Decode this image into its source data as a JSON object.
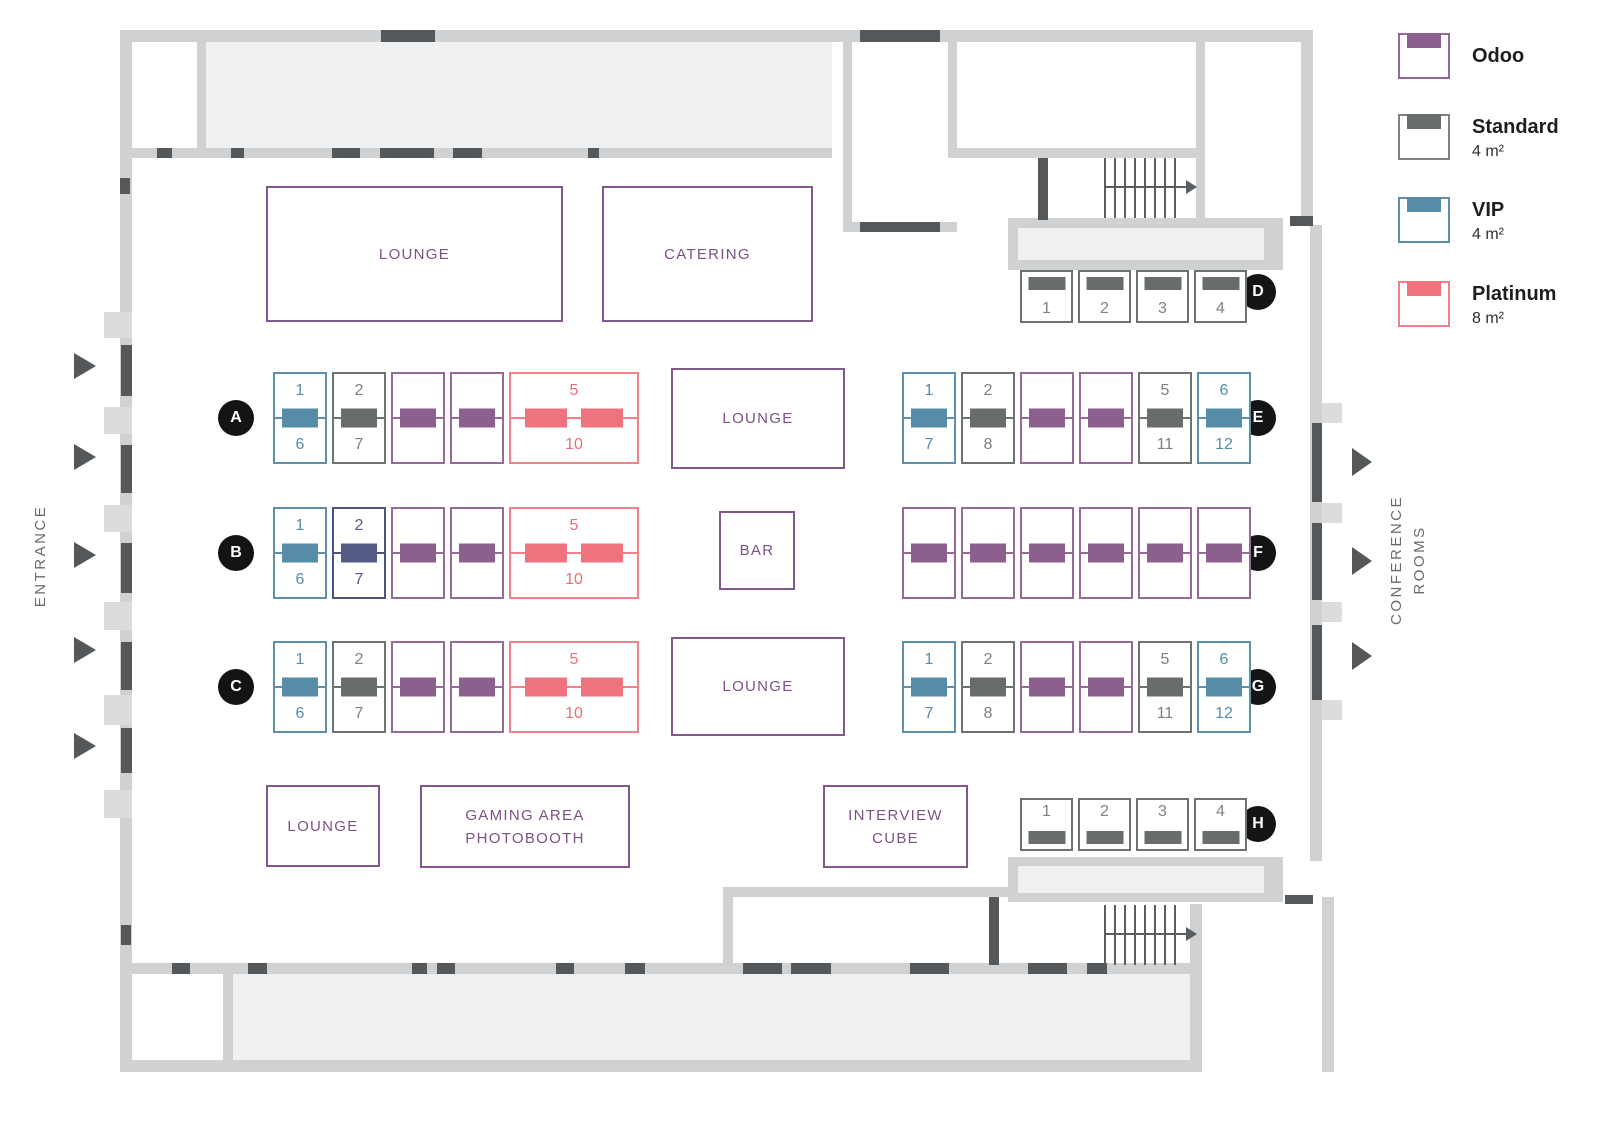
{
  "colors": {
    "odoo": "#8D5F8E",
    "standard": "#686C6D",
    "vip": "#568CA8",
    "platinum": "#EE737E",
    "highlight_indigo": "#565A86",
    "wall": "#D0D1D2",
    "door_segment": "#54585A",
    "room_fill": "#EEF0F1",
    "area_label": "#7C5184"
  },
  "legend": {
    "items": [
      {
        "type": "odoo",
        "label": "Odoo",
        "size": ""
      },
      {
        "type": "standard",
        "label": "Standard",
        "size": "4 m²"
      },
      {
        "type": "vip",
        "label": "VIP",
        "size": "4 m²"
      },
      {
        "type": "platinum",
        "label": "Platinum",
        "size": "8 m²"
      }
    ]
  },
  "side_labels": {
    "entrance": "ENTRANCE",
    "conference_line1": "CONFERENCE",
    "conference_line2": "ROOMS"
  },
  "areas": {
    "lounge_top": "LOUNGE",
    "catering": "CATERING",
    "lounge_center_upper": "LOUNGE",
    "bar": "BAR",
    "lounge_center_lower": "LOUNGE",
    "lounge_bottom": "LOUNGE",
    "gaming_line1": "GAMING AREA",
    "gaming_line2": "PHOTOBOOTH",
    "interview_line1": "INTERVIEW",
    "interview_line2": "CUBE"
  },
  "rows": {
    "A": {
      "letter": "A",
      "booths": [
        {
          "type": "vip",
          "top": "1",
          "bottom": "6"
        },
        {
          "type": "standard",
          "top": "2",
          "bottom": "7"
        },
        {
          "type": "odoo"
        },
        {
          "type": "odoo"
        },
        {
          "type": "platinum",
          "top": "5",
          "bottom": "10"
        }
      ]
    },
    "B": {
      "letter": "B",
      "booths": [
        {
          "type": "vip",
          "top": "1",
          "bottom": "6"
        },
        {
          "type": "indigo",
          "top": "2",
          "bottom": "7"
        },
        {
          "type": "odoo"
        },
        {
          "type": "odoo"
        },
        {
          "type": "platinum",
          "top": "5",
          "bottom": "10"
        }
      ]
    },
    "C": {
      "letter": "C",
      "booths": [
        {
          "type": "vip",
          "top": "1",
          "bottom": "6"
        },
        {
          "type": "standard",
          "top": "2",
          "bottom": "7"
        },
        {
          "type": "odoo"
        },
        {
          "type": "odoo"
        },
        {
          "type": "platinum",
          "top": "5",
          "bottom": "10"
        }
      ]
    },
    "D": {
      "letter": "D",
      "booths": [
        {
          "type": "standard",
          "num": "1"
        },
        {
          "type": "standard",
          "num": "2"
        },
        {
          "type": "standard",
          "num": "3"
        },
        {
          "type": "standard",
          "num": "4"
        }
      ]
    },
    "E": {
      "letter": "E",
      "booths": [
        {
          "type": "vip",
          "top": "1",
          "bottom": "7"
        },
        {
          "type": "standard",
          "top": "2",
          "bottom": "8"
        },
        {
          "type": "odoo"
        },
        {
          "type": "odoo"
        },
        {
          "type": "standard",
          "top": "5",
          "bottom": "11"
        },
        {
          "type": "vip",
          "top": "6",
          "bottom": "12"
        }
      ]
    },
    "F": {
      "letter": "F",
      "booths": [
        {
          "type": "odoo"
        },
        {
          "type": "odoo"
        },
        {
          "type": "odoo"
        },
        {
          "type": "odoo"
        },
        {
          "type": "odoo"
        },
        {
          "type": "odoo"
        }
      ]
    },
    "G": {
      "letter": "G",
      "booths": [
        {
          "type": "vip",
          "top": "1",
          "bottom": "7"
        },
        {
          "type": "standard",
          "top": "2",
          "bottom": "8"
        },
        {
          "type": "odoo"
        },
        {
          "type": "odoo"
        },
        {
          "type": "standard",
          "top": "5",
          "bottom": "11"
        },
        {
          "type": "vip",
          "top": "6",
          "bottom": "12"
        }
      ]
    },
    "H": {
      "letter": "H",
      "booths": [
        {
          "type": "standard",
          "num": "1"
        },
        {
          "type": "standard",
          "num": "2"
        },
        {
          "type": "standard",
          "num": "3"
        },
        {
          "type": "standard",
          "num": "4"
        }
      ]
    }
  }
}
